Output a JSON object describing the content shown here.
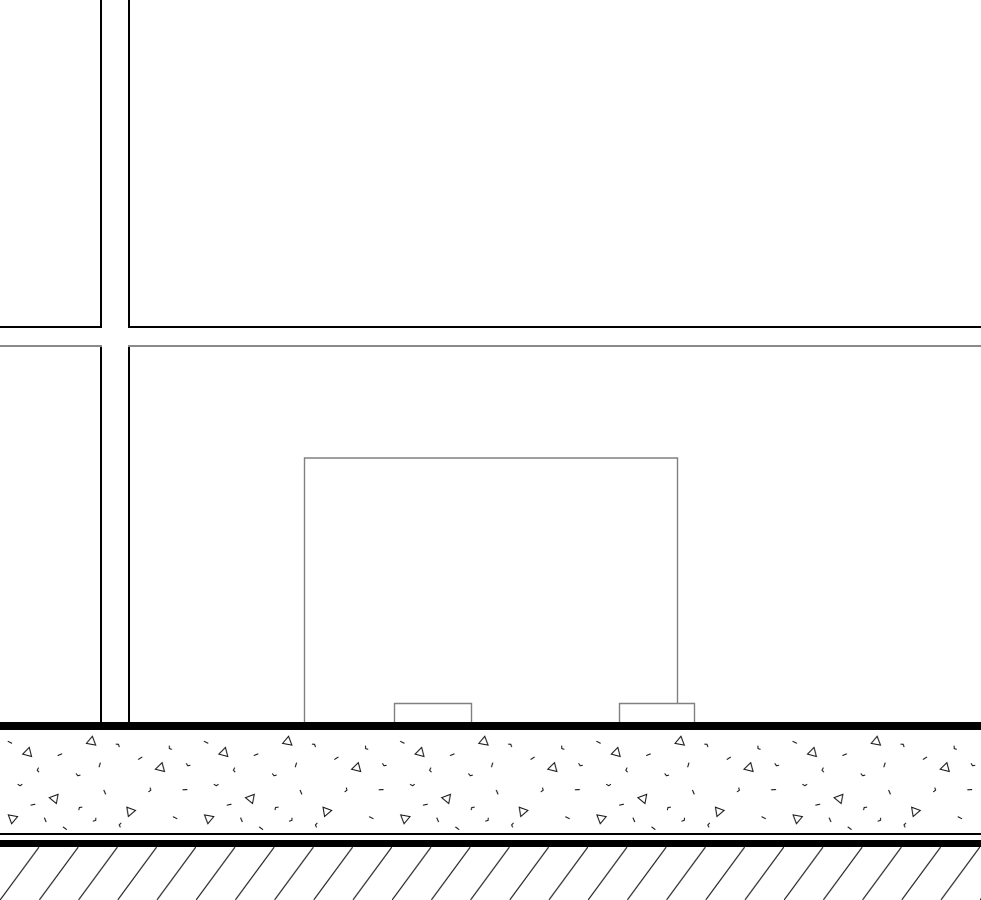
{
  "canvas": {
    "width": 981,
    "height": 900,
    "background": "#ffffff"
  },
  "colors": {
    "wall_line": "#000000",
    "upper_level_line": "#000000",
    "lower_level_line": "#8a8a8a",
    "equipment_outline": "#808080",
    "slab_heavy_line": "#000000",
    "thin_line": "#000000",
    "concrete_speck": "#141414",
    "concrete_fill": "#ffffff",
    "earth_hatch": "#262626"
  },
  "patterns": {
    "concrete_band": "concrete-stipple-with-aggregate-triangles",
    "earth_band": "diagonal-earth-hatch"
  },
  "hatch": {
    "angle_deg": 54,
    "spacing_px": 39
  },
  "elements": {
    "wall_faces_x": [
      101,
      129
    ],
    "upper_level_line_y": 327,
    "lower_level_line_y": 346,
    "equipment_box": {
      "left": 304,
      "top": 458,
      "right": 678,
      "bottom": 722
    },
    "equipment_feet": [
      {
        "left": 394,
        "right": 471,
        "top": 703
      },
      {
        "left": 619,
        "right": 695,
        "top": 703
      }
    ],
    "slab_top_y": 722,
    "slab_thin_line_y": 833,
    "slab_heavy_line_y": 840,
    "earth_band_top_y": 847
  }
}
